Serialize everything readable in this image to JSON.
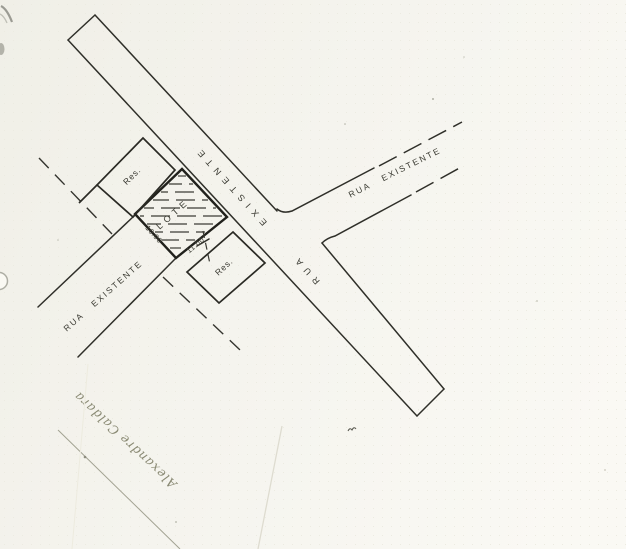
{
  "drawing": {
    "streets": {
      "main_road_label": "RUA EXISTENTE",
      "left_street_label": "RUA EXISTENTE",
      "branch_street_label": "RUA EXISTENTE"
    },
    "lot": {
      "label": "LOTE",
      "dimension_left": "10.00",
      "dimension_right": "11.00"
    },
    "residences": {
      "upper_label": "Res.",
      "lower_label": "Res."
    },
    "handwriting": {
      "text": "Alexandre Caldara"
    },
    "colors": {
      "paper": "#f5f4ee",
      "ink": "#2f2f29",
      "pencil": "#8a8a74"
    }
  }
}
